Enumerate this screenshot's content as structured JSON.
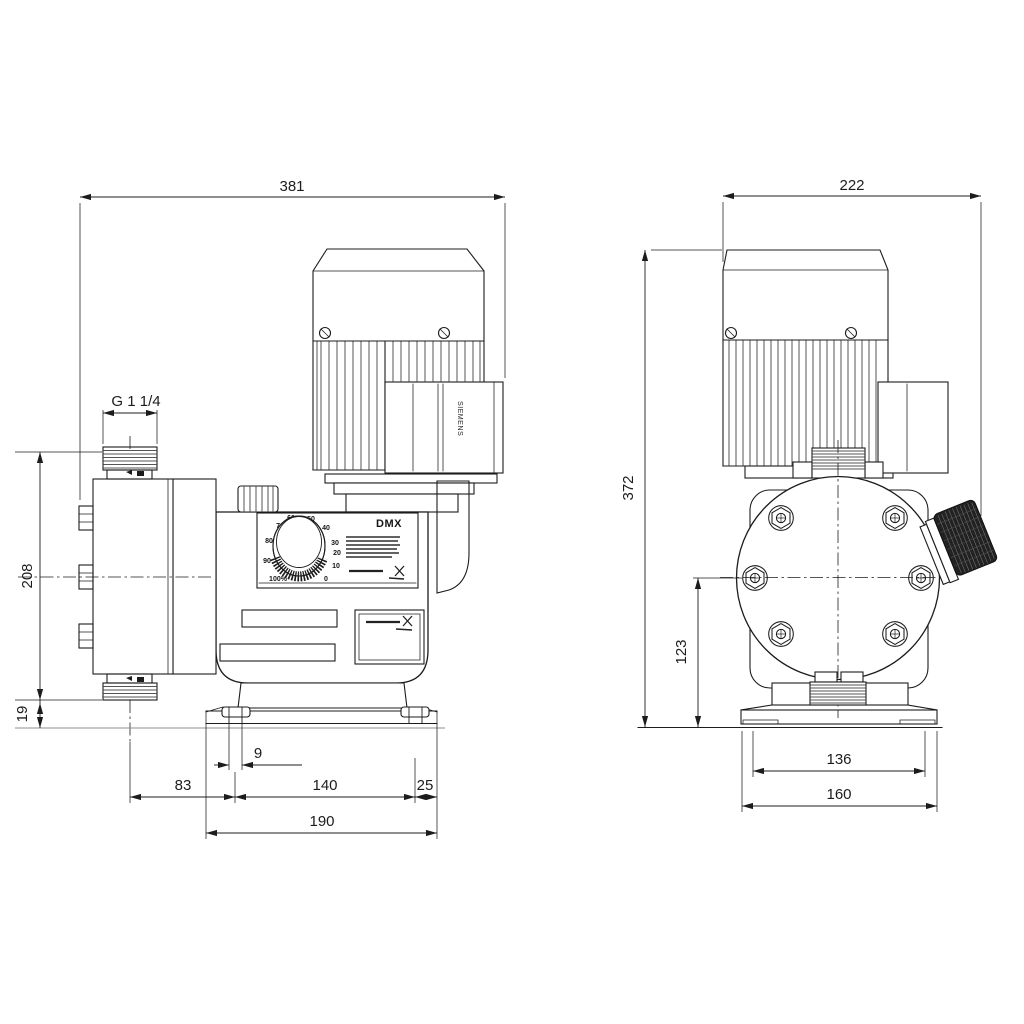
{
  "front_view": {
    "dims": {
      "total_width": "381",
      "thread_size": "G 1 1/4",
      "head_height": "208",
      "base_height": "19",
      "slot_width": "9",
      "center_to_slot": "83",
      "slot_spacing": "140",
      "slot_to_edge": "25",
      "base_width": "190"
    },
    "panel": {
      "model": "DMX",
      "dial_labels": [
        "100%",
        "90",
        "80",
        "70",
        "60",
        "50",
        "40",
        "30",
        "20",
        "10",
        "0"
      ]
    },
    "motor_brand": "SIEMENS"
  },
  "side_view": {
    "dims": {
      "total_width": "222",
      "total_height": "372",
      "centerline_to_base": "123",
      "slot_spacing": "136",
      "base_width": "160"
    }
  }
}
